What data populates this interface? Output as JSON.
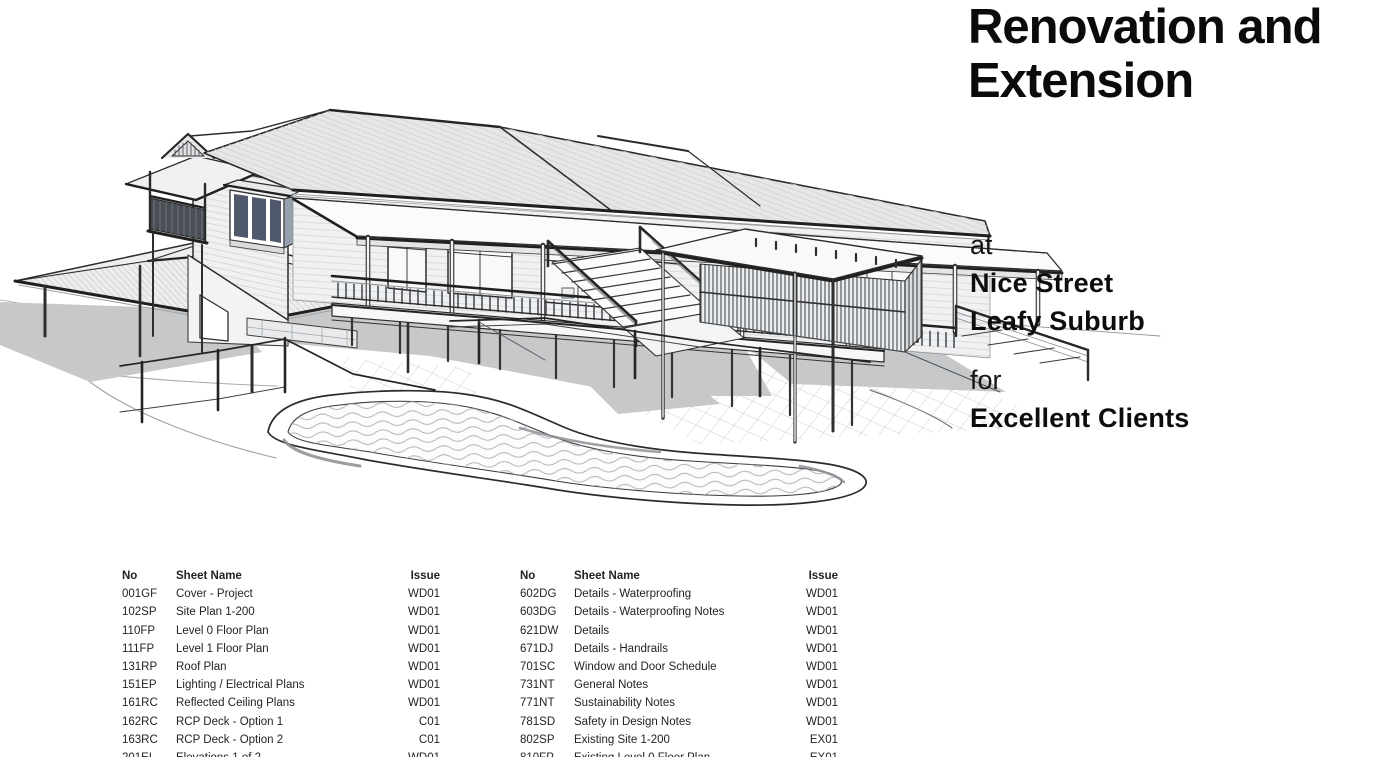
{
  "project": {
    "title": "Renovation and Extension",
    "location_prefix": "at",
    "address_line1": "Nice Street",
    "address_line2": "Leafy Suburb",
    "client_prefix": "for",
    "client_name": "Excellent Clients"
  },
  "hero_render": {
    "name": "house-3d-line-render",
    "subject": "Two-storey house with verandah deck, stairs, two carports, pool fence and swimming pool"
  },
  "sheet_index": {
    "headers": {
      "no": "No",
      "name": "Sheet Name",
      "issue": "Issue"
    },
    "left_rows": [
      {
        "no": "001GF",
        "name": "Cover - Project",
        "issue": "WD01"
      },
      {
        "no": "102SP",
        "name": "Site Plan 1-200",
        "issue": "WD01"
      },
      {
        "no": "110FP",
        "name": "Level 0 Floor Plan",
        "issue": "WD01"
      },
      {
        "no": "111FP",
        "name": "Level 1 Floor Plan",
        "issue": "WD01"
      },
      {
        "no": "131RP",
        "name": "Roof Plan",
        "issue": "WD01"
      },
      {
        "no": "151EP",
        "name": "Lighting / Electrical Plans",
        "issue": "WD01"
      },
      {
        "no": "161RC",
        "name": "Reflected Ceiling Plans",
        "issue": "WD01"
      },
      {
        "no": "162RC",
        "name": "RCP Deck - Option 1",
        "issue": "C01"
      },
      {
        "no": "163RC",
        "name": "RCP Deck - Option 2",
        "issue": "C01"
      },
      {
        "no": "201EL",
        "name": "Elevations 1 of 2",
        "issue": "WD01"
      }
    ],
    "right_rows": [
      {
        "no": "602DG",
        "name": "Details - Waterproofing",
        "issue": "WD01"
      },
      {
        "no": "603DG",
        "name": "Details - Waterproofing Notes",
        "issue": "WD01"
      },
      {
        "no": "621DW",
        "name": "Details",
        "issue": "WD01"
      },
      {
        "no": "671DJ",
        "name": "Details - Handrails",
        "issue": "WD01"
      },
      {
        "no": "701SC",
        "name": "Window and Door Schedule",
        "issue": "WD01"
      },
      {
        "no": "731NT",
        "name": "General Notes",
        "issue": "WD01"
      },
      {
        "no": "771NT",
        "name": "Sustainability Notes",
        "issue": "WD01"
      },
      {
        "no": "781SD",
        "name": "Safety in Design Notes",
        "issue": "WD01"
      },
      {
        "no": "802SP",
        "name": "Existing Site 1-200",
        "issue": "EX01"
      },
      {
        "no": "810FP",
        "name": "Existing Level 0 Floor Plan",
        "issue": "EX01"
      }
    ]
  },
  "colors": {
    "ink": "#1e1e1e",
    "roof_fill": "#e6e7e9",
    "wall_fill": "#f0f1f2",
    "shadow": "#c6c8ca",
    "glass_dark": "#4f596b",
    "water_line": "#aeb3b7"
  }
}
